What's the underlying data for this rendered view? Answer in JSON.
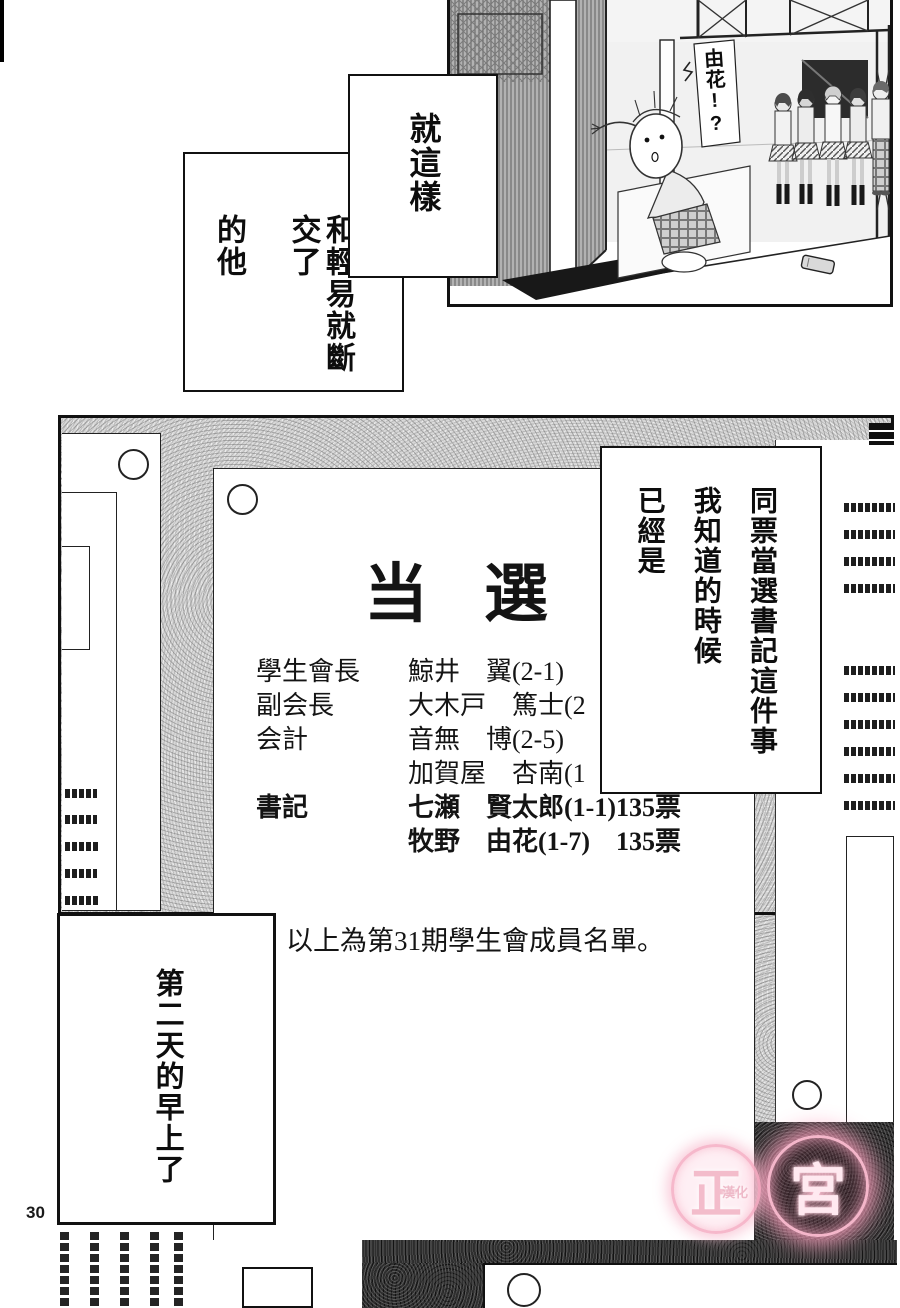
{
  "page": {
    "number": "30",
    "background": "#ffffff"
  },
  "top_panel": {
    "handwritten_text": "由花!?"
  },
  "bubbles": {
    "bubble1": "就這樣",
    "bubble2_line1": "和輕易就斷交了",
    "bubble2_line2": "的他",
    "bubble3_line1": "同票當選書記這件事",
    "bubble3_line2": "我知道的時候",
    "bubble3_line3": "已經是",
    "caption_morning": "第二天的早上了"
  },
  "poster": {
    "title": "当選",
    "rows": [
      {
        "role": "學生會長",
        "name": "鯨井　翼(2-1)"
      },
      {
        "role": "副会長",
        "name": "大木戸　篤士(2"
      },
      {
        "role": "会計",
        "name": "音無　博(2-5)"
      },
      {
        "role": "",
        "name": "加賀屋　杏南(1"
      },
      {
        "role": "書記",
        "name": "七瀬　賢太郎(1-1)135票"
      },
      {
        "role": "",
        "name": "牧野　由花(1-7)　135票"
      }
    ],
    "footer": "以上為第31期學生會成員名單。"
  },
  "watermark": {
    "char1": "正",
    "char2": "宮",
    "subtext": "漢化",
    "color": "#f5b7c8"
  }
}
